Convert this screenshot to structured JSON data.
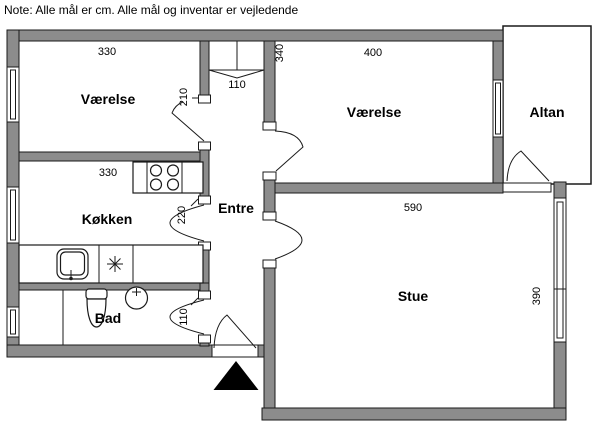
{
  "note": "Note: Alle mål er cm. Alle mål og inventar er vejledende",
  "rooms": {
    "vaerelse1": "Værelse",
    "koekken": "Køkken",
    "bad": "Bad",
    "entre": "Entre",
    "vaerelse2": "Værelse",
    "stue": "Stue",
    "altan": "Altan"
  },
  "dimensions_cm": {
    "vaerelse1_width": "330",
    "vaerelse1_door": "210",
    "closet_width": "110",
    "koekken_width": "330",
    "koekken_door": "220",
    "bad_door": "110",
    "vaerelse2_width": "400",
    "vaerelse2_height": "340",
    "stue_width": "590",
    "stue_height": "390"
  },
  "colors": {
    "wall_fill": "#8c8c8c",
    "line": "#1a1a1a",
    "background": "#ffffff"
  }
}
